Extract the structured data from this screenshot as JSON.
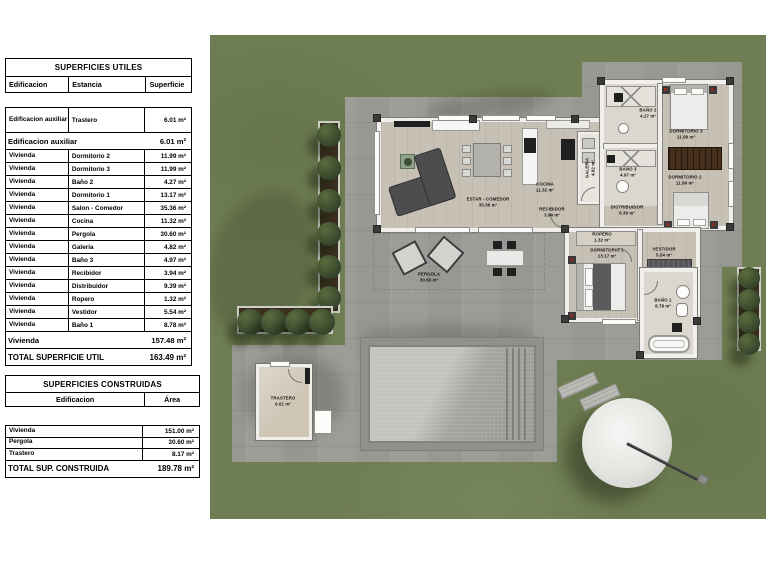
{
  "colors": {
    "grass": "#6f7e52",
    "paving": "#9d9d98",
    "wall": "#f0efec",
    "wood": "#c7c0b4",
    "bath": "#dbd7cf",
    "deck": "#90908c",
    "pool_light": "#c2c2be",
    "pool_dark": "#9a9a96",
    "planter": "#3b2f1f",
    "wardrobe": "#46301d",
    "parasol": "#e4e4e1"
  },
  "tables": {
    "utiles": {
      "title": "SUPERFICIES UTILES",
      "columns": [
        "Edificacion",
        "Estancia",
        "Superficie"
      ],
      "rows": [
        {
          "type": "data",
          "tall": true,
          "edificacion": "Edificacion auxiliar",
          "estancia": "Trastero",
          "superficie": "6.01 m²"
        },
        {
          "type": "subtotal",
          "label": "Edificacion auxiliar",
          "value": "6.01 m²"
        },
        {
          "type": "data",
          "edificacion": "Vivienda",
          "estancia": "Dormitorio 2",
          "superficie": "11.99 m²"
        },
        {
          "type": "data",
          "edificacion": "Vivienda",
          "estancia": "Dormitorio 3",
          "superficie": "11.99 m²"
        },
        {
          "type": "data",
          "edificacion": "Vivienda",
          "estancia": "Baño 2",
          "superficie": "4.27 m²"
        },
        {
          "type": "data",
          "edificacion": "Vivienda",
          "estancia": "Dormitorio 1",
          "superficie": "13.17 m²"
        },
        {
          "type": "data",
          "edificacion": "Vivienda",
          "estancia": "Salon - Comedor",
          "superficie": "35.36 m²"
        },
        {
          "type": "data",
          "edificacion": "Vivienda",
          "estancia": "Cocina",
          "superficie": "11.32 m²"
        },
        {
          "type": "data",
          "edificacion": "Vivienda",
          "estancia": "Pergola",
          "superficie": "30.60 m²"
        },
        {
          "type": "data",
          "edificacion": "Vivienda",
          "estancia": "Galeria",
          "superficie": "4.82 m²"
        },
        {
          "type": "data",
          "edificacion": "Vivienda",
          "estancia": "Baño 3",
          "superficie": "4.97 m²"
        },
        {
          "type": "data",
          "edificacion": "Vivienda",
          "estancia": "Recibidor",
          "superficie": "3.94 m²"
        },
        {
          "type": "data",
          "edificacion": "Vivienda",
          "estancia": "Distribuidor",
          "superficie": "9.39 m²"
        },
        {
          "type": "data",
          "edificacion": "Vivienda",
          "estancia": "Ropero",
          "superficie": "1.32 m²"
        },
        {
          "type": "data",
          "edificacion": "Vivienda",
          "estancia": "Vestidor",
          "superficie": "5.54 m²"
        },
        {
          "type": "data",
          "edificacion": "Vivienda",
          "estancia": "Baño 1",
          "superficie": "8.78 m²"
        },
        {
          "type": "subtotal",
          "label": "Vivienda",
          "value": "157.48 m²"
        },
        {
          "type": "total",
          "label": "TOTAL SUPERFICIE UTIL",
          "value": "163.49 m²"
        }
      ]
    },
    "construidas": {
      "title": "SUPERFICIES CONSTRUIDAS",
      "columns": [
        "Edificacion",
        "Área"
      ],
      "rows": [
        [
          "Vivienda",
          "151.00 m²"
        ],
        [
          "Pergola",
          "30.60 m²"
        ],
        [
          "Trastero",
          "8.17 m²"
        ]
      ],
      "total": {
        "label": "TOTAL SUP. CONSTRUIDA",
        "value": "189.78 m²"
      }
    }
  },
  "plan": {
    "labels": [
      {
        "id": "estar-comedor",
        "name": "ESTAR - COMEDOR",
        "area": "35.36 m²",
        "x": 278,
        "y": 168
      },
      {
        "id": "cocina",
        "name": "COCINA",
        "area": "11.32 m²",
        "x": 335,
        "y": 153
      },
      {
        "id": "recibidor",
        "name": "RECIBIDOR",
        "area": "3.94 m²",
        "x": 342,
        "y": 178
      },
      {
        "id": "galeria",
        "name": "GALERIA",
        "area": "4.82 m²",
        "x": 381,
        "y": 133,
        "rot": -90
      },
      {
        "id": "bano-3",
        "name": "BAÑO 3",
        "area": "4.97 m²",
        "x": 418,
        "y": 138
      },
      {
        "id": "bano-2",
        "name": "BAÑO 2",
        "area": "4.27 m²",
        "x": 438,
        "y": 79
      },
      {
        "id": "dormitorio-3",
        "name": "DORMITORIO 3",
        "area": "11.99 m²",
        "x": 476,
        "y": 100
      },
      {
        "id": "dormitorio-2",
        "name": "DORMITORIO 2",
        "area": "11.99 m²",
        "x": 475,
        "y": 146
      },
      {
        "id": "distribuidor",
        "name": "DISTRIBUIDOR",
        "area": "9.39 m²",
        "x": 417,
        "y": 176
      },
      {
        "id": "ropero",
        "name": "ROPERO",
        "area": "1.32 m²",
        "x": 392,
        "y": 203
      },
      {
        "id": "dormitorio-1",
        "name": "DORMITORIO 1",
        "area": "13.17 m²",
        "x": 397,
        "y": 219
      },
      {
        "id": "vestidor",
        "name": "VESTIDOR",
        "area": "5.54 m²",
        "x": 454,
        "y": 218
      },
      {
        "id": "bano-1",
        "name": "BAÑO 1",
        "area": "8.78 m²",
        "x": 453,
        "y": 269
      },
      {
        "id": "pergola",
        "name": "PERGOLA",
        "area": "30.60 m²",
        "x": 219,
        "y": 243
      },
      {
        "id": "trastero",
        "name": "TRASTERO",
        "area": "6.01 m²",
        "x": 73,
        "y": 367
      }
    ]
  }
}
